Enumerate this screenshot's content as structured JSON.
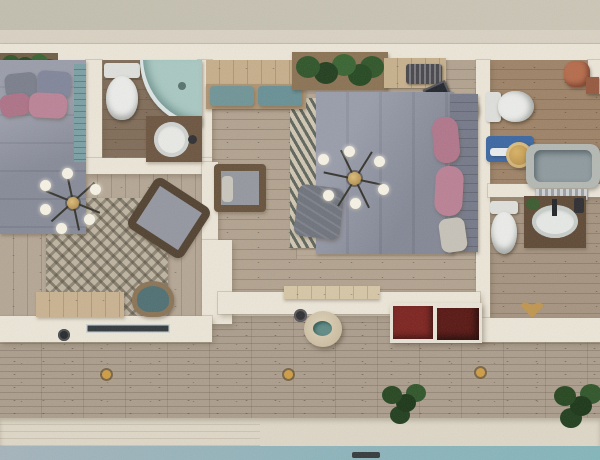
{
  "scene": {
    "type": "3d-architectural-floor-plan-render",
    "view": "top-down",
    "description": "Photorealistic top-down 3D render of an apartment: two bedrooms, two bathrooms plus an en-suite vanity room, central hallway, wooden deck terrace with red stairs, planters, deck lights and the edge of a swimming pool at the bottom.",
    "rooms": [
      {
        "name": "bedroom-left",
        "furniture": [
          "double-bed",
          "gray-pillows",
          "pink-pillows",
          "teal-headboard",
          "sputnik-chandelier",
          "patterned-rug",
          "armchair",
          "wood-bench",
          "teal-stool",
          "planter-box"
        ]
      },
      {
        "name": "bathroom-left",
        "furniture": [
          "toilet",
          "corner-shower",
          "wood-vanity-with-round-sink"
        ]
      },
      {
        "name": "hallway",
        "furniture": [
          "entry-bench-with-teal-cushions",
          "lounge-chair"
        ]
      },
      {
        "name": "bedroom-master",
        "furniture": [
          "double-bed",
          "pink-bolster-pillows",
          "headboard",
          "sputnik-chandelier",
          "jute-rug",
          "chevron-runner-rug",
          "planter-box",
          "wood-bench",
          "radiator",
          "black-book",
          "straw-hat",
          "gray-throw"
        ]
      },
      {
        "name": "bathroom-ensuite",
        "furniture": [
          "toilet",
          "blue-bench",
          "gold-stool",
          "bathtub",
          "terracotta-pots"
        ]
      },
      {
        "name": "vanity-room",
        "furniture": [
          "toilet",
          "wood-vanity-with-oval-sink",
          "striped-mirror",
          "gold-shell-ornament"
        ]
      }
    ],
    "exterior": {
      "elements": [
        "wood-deck-terrace",
        "red-deck-stairs",
        "round-pouf-table",
        "outdoor-faucet",
        "deck-lights",
        "deck-plants",
        "window-slot",
        "concrete-pool-edge",
        "swimming-pool",
        "pool-ladder"
      ]
    },
    "palette": {
      "background_beige": "#d6cfc0",
      "background_top": "#c8c2b3",
      "wall_cream": "#ece6d8",
      "deck_wood": "#ab9d8c",
      "interior_wood": "#b5a694",
      "bathroom_wood": "#7f6b57",
      "duvet_gray": "#8e92a0",
      "pillow_pink": "#b3778c",
      "headboard_teal": "#7ba0a4",
      "cushion_teal": "#6f9496",
      "stair_red": "#7c211d",
      "bench_blue": "#3a66a2",
      "gold_accent": "#c69a4d",
      "pool_left": "#a5b3bb",
      "pool_right": "#83b5ba",
      "concrete": "#ded7c7",
      "plant_green": "#2e5428"
    }
  }
}
